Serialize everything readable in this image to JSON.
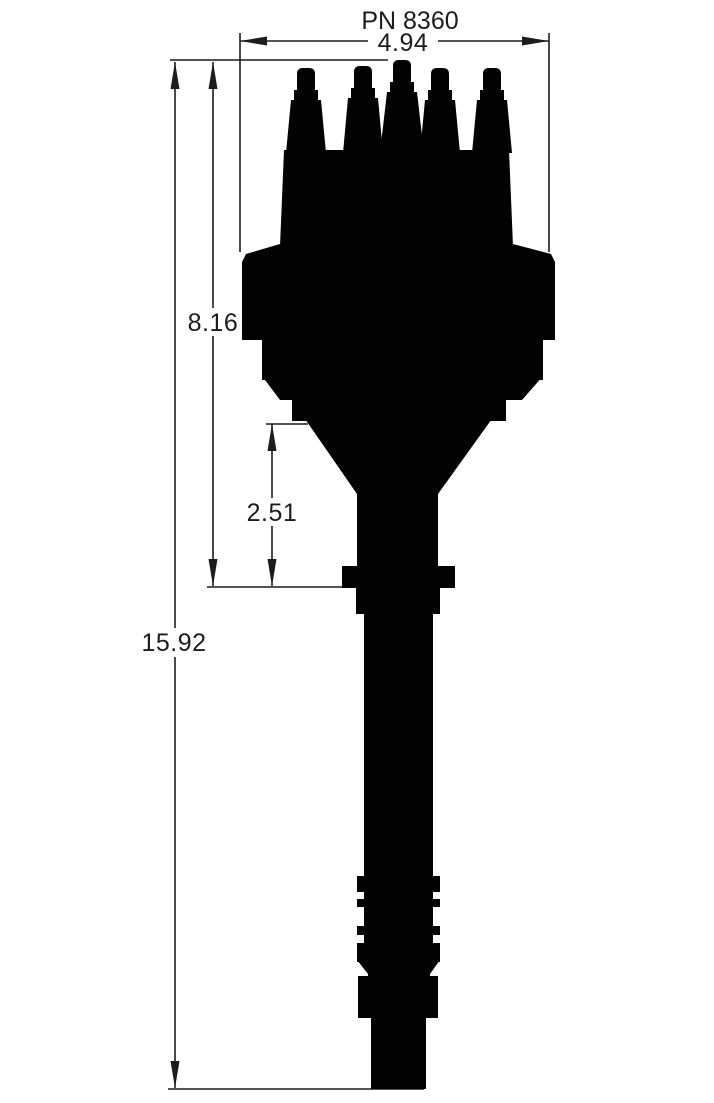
{
  "drawing": {
    "title": "PN 8360",
    "dimensions": {
      "cap_width": {
        "label": "4.94"
      },
      "cap_to_collar": {
        "label": "8.16"
      },
      "funnel_to_collar": {
        "label": "2.51"
      },
      "overall_length": {
        "label": "15.92"
      }
    },
    "colors": {
      "ink": "#030303",
      "background": "#ffffff"
    }
  }
}
